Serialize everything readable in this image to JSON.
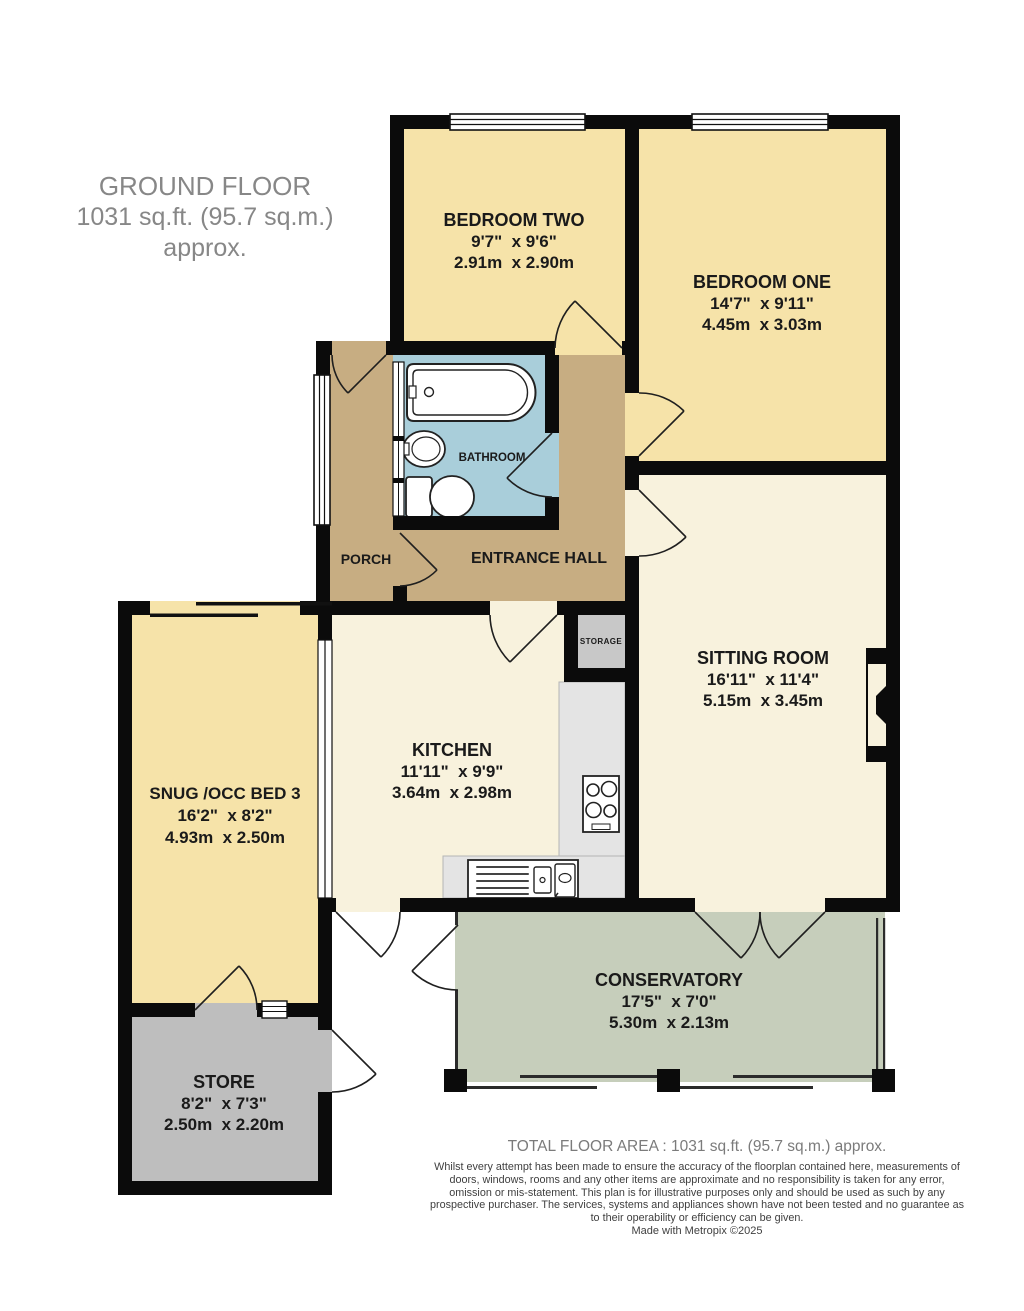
{
  "header": {
    "title": "GROUND FLOOR",
    "subtitle": "1031 sq.ft. (95.7 sq.m.) approx."
  },
  "rooms": {
    "bedroom_two": {
      "name": "BEDROOM TWO",
      "imperial": "9'7\"  x 9'6\"",
      "metric": "2.91m  x 2.90m"
    },
    "bedroom_one": {
      "name": "BEDROOM ONE",
      "imperial": "14'7\"  x 9'11\"",
      "metric": "4.45m  x 3.03m"
    },
    "bathroom": {
      "name": "BATHROOM"
    },
    "porch": {
      "name": "PORCH"
    },
    "entrance_hall": {
      "name": "ENTRANCE HALL"
    },
    "storage": {
      "name": "STORAGE"
    },
    "sitting_room": {
      "name": "SITTING ROOM",
      "imperial": "16'11\"  x 11'4\"",
      "metric": "5.15m  x 3.45m"
    },
    "kitchen": {
      "name": "KITCHEN",
      "imperial": "11'11\"  x 9'9\"",
      "metric": "3.64m  x 2.98m"
    },
    "snug": {
      "name": "SNUG /OCC BED 3",
      "imperial": "16'2\"  x 8'2\"",
      "metric": "4.93m  x 2.50m"
    },
    "conservatory": {
      "name": "CONSERVATORY",
      "imperial": "17'5\"  x 7'0\"",
      "metric": "5.30m  x 2.13m"
    },
    "store": {
      "name": "STORE",
      "imperial": "8'2\"  x 7'3\"",
      "metric": "2.50m  x 2.20m"
    }
  },
  "footer": {
    "total_area": "TOTAL FLOOR AREA : 1031 sq.ft. (95.7 sq.m.) approx.",
    "disclaimer": "Whilst every attempt has been made to ensure the accuracy of the floorplan contained here, measurements of doors, windows, rooms and any other items are approximate and no responsibility is taken for any error, omission or mis-statement. This plan is for illustrative purposes only and should be used as such by any prospective purchaser. The services, systems and appliances shown have not been tested and no guarantee as to their operability or efficiency can be given.",
    "credit": "Made with Metropix ©2025"
  },
  "colors": {
    "bedroom_yellow": "#F6E3A9",
    "living_cream": "#F8F2DD",
    "hall_tan": "#C7AD82",
    "bathroom_blue": "#A9CEDA",
    "conservatory_sage": "#C6CEBB",
    "store_gray": "#BEBEBE",
    "storage_gray": "#C8C8C8",
    "counter_gray": "#E4E4E4",
    "wall_black": "#0B0B0B"
  }
}
